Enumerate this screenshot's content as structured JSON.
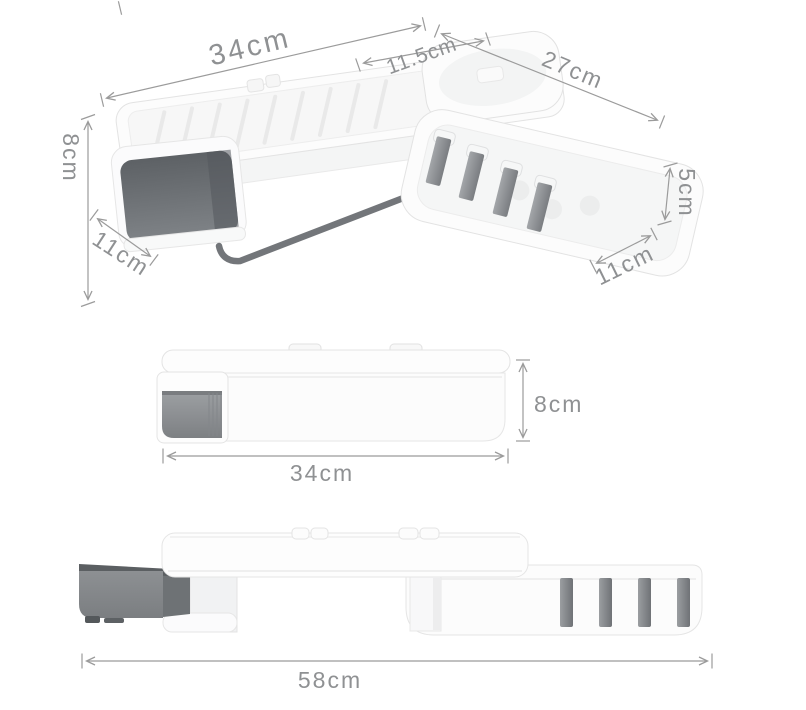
{
  "palette": {
    "background": "#ffffff",
    "dimension_line": "#9b9b9b",
    "dimension_text": "#8f9193",
    "product_white": "#fcfcfc",
    "product_border": "#e5e5e5",
    "drawer_dark_gray": "#5d6165",
    "drawer_mid_gray": "#85888b",
    "hook_gray": "#8f9296",
    "towel_bar_gray": "#73767a"
  },
  "views": {
    "perspective": {
      "dims": {
        "tray_length": "34cm",
        "cup_width": "11.5cm",
        "basket_length": "27cm",
        "tray_height": "8cm",
        "tray_depth": "11cm",
        "basket_height": "5cm",
        "basket_depth": "11cm"
      }
    },
    "front_folded": {
      "dims": {
        "width": "34cm",
        "height": "8cm"
      }
    },
    "front_extended": {
      "dims": {
        "total_width": "58cm"
      }
    }
  }
}
